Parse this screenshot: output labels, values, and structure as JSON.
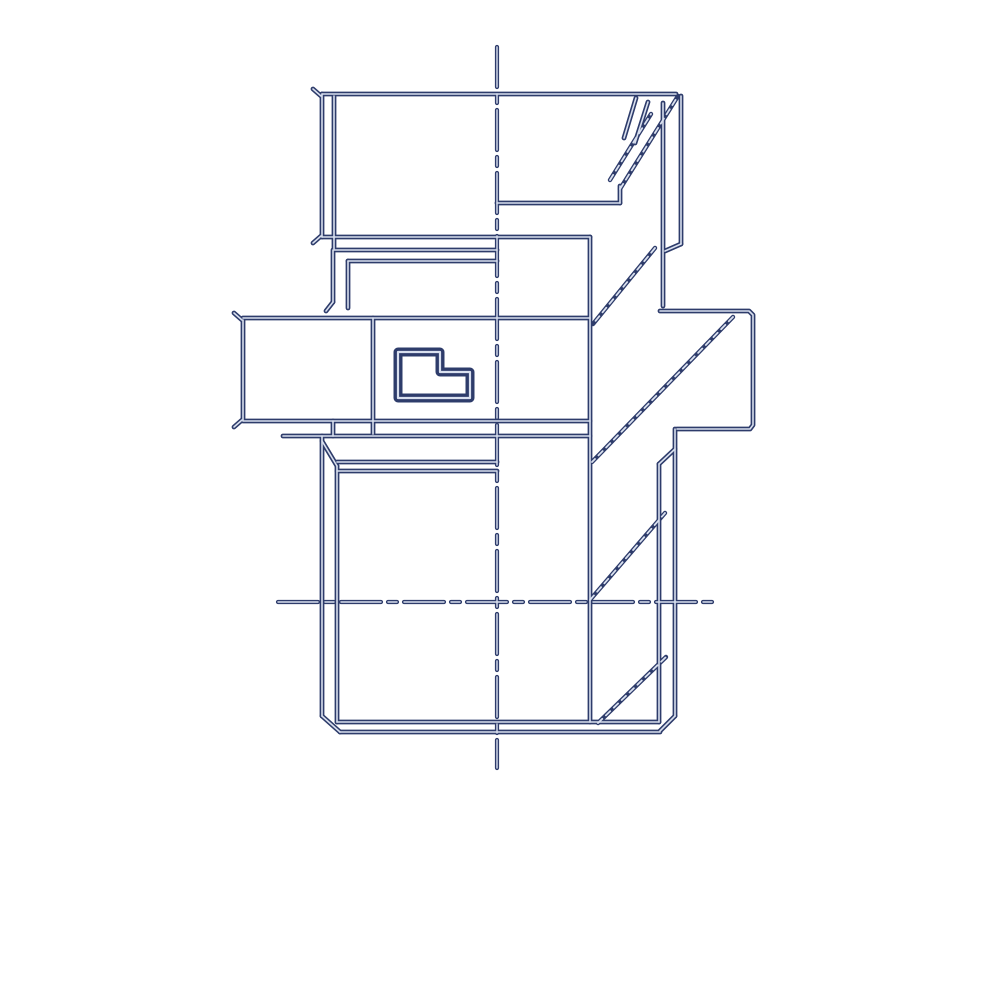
{
  "meta": {
    "description": "Technical line drawing of a hydraulic straight adapter fitting, side view with hex flats, male threaded stud and dash-dot centerlines"
  },
  "drawing": {
    "background": "#ffffff",
    "stroke_color": "#2e3c6b",
    "highlight_color": "#d9e0ef",
    "viewbox": "0 0 1000 1000",
    "layers": [
      {
        "name": "centerlines",
        "width": 4.2,
        "dash": "40 7 9 7",
        "highlight_width": 1.4,
        "highlight_dash": "40 7 9 7",
        "paths": [
          {
            "name": "vertical-centerline",
            "d": "M 497 47 L 497 768"
          },
          {
            "name": "horizontal-centerline",
            "d": "M 278 602 L 718 602"
          }
        ]
      },
      {
        "name": "outline",
        "width": 4.8,
        "highlight_width": 1.6,
        "paths": [
          {
            "name": "nut-top-edge",
            "d": "M 322 94 L 676 94"
          },
          {
            "name": "nut-left-edge",
            "d": "M 322 94 L 322 237"
          },
          {
            "name": "nut-left-facet",
            "d": "M 334 96 L 334 249"
          },
          {
            "name": "nut-right-edge",
            "d": "M 681 96 L 681 244"
          },
          {
            "name": "nut-right-facet",
            "d": "M 663 103 L 663 306"
          },
          {
            "name": "nut-bottom-edge",
            "d": "M 322 237 L 590 237"
          },
          {
            "name": "nut-washer-line",
            "d": "M 334 250 L 497 250"
          },
          {
            "name": "step-upper-line",
            "d": "M 497 203 L 620 203"
          },
          {
            "name": "step-stub",
            "d": "M 620 186 L 620 203"
          },
          {
            "name": "nut-corner-step",
            "d": "M 681 244 L 665 251"
          },
          {
            "name": "neck-left-outer",
            "d": "M 333 250 L 333 302"
          },
          {
            "name": "neck-flare",
            "d": "M 333 302 L 326 311"
          },
          {
            "name": "neck-left-inner",
            "d": "M 348 261 L 348 308"
          },
          {
            "name": "neck-shoulder",
            "d": "M 348 261 L 497 261"
          },
          {
            "name": "body-right-edge",
            "d": "M 590 237 L 590 722"
          },
          {
            "name": "flange-outline",
            "d": "M 660 311 L 749 311 L 753 315 L 753 425 L 750 429 L 677 429"
          },
          {
            "name": "hex-top-edge",
            "d": "M 243 318 L 590 318"
          },
          {
            "name": "hex-left-edge",
            "d": "M 243 320 L 243 420"
          },
          {
            "name": "hex-facet",
            "d": "M 373 318 L 373 434"
          },
          {
            "name": "hex-bottom-near",
            "d": "M 243 421 L 590 421"
          },
          {
            "name": "hex-bottom-far",
            "d": "M 283 436 L 590 436"
          },
          {
            "name": "hex-step",
            "d": "M 333 421 L 333 436"
          },
          {
            "name": "stud-left-major",
            "d": "M 322 436 L 322 716"
          },
          {
            "name": "stud-left-chamfer-top",
            "d": "M 322 441 L 337 466"
          },
          {
            "name": "stud-left-minor",
            "d": "M 337 466 L 337 722"
          },
          {
            "name": "thread-runout-a",
            "d": "M 337 462 L 497 462"
          },
          {
            "name": "thread-runout-b",
            "d": "M 337 471 L 497 471"
          },
          {
            "name": "stud-right-major",
            "d": "M 675 429 L 675 716"
          },
          {
            "name": "stud-right-chamfer-top",
            "d": "M 675 449 L 659 464"
          },
          {
            "name": "stud-right-minor",
            "d": "M 659 464 L 659 722"
          },
          {
            "name": "stud-bottom-chamfer-left",
            "d": "M 322 716 L 340 732"
          },
          {
            "name": "stud-bottom-face",
            "d": "M 340 732 L 660 732"
          },
          {
            "name": "stud-end-inner-line",
            "d": "M 337 722 L 659 722"
          },
          {
            "name": "stud-bottom-chamfer-right",
            "d": "M 675 716 L 660 731"
          },
          {
            "name": "tick-nut-top-left",
            "d": "M 321 96 L 313 89"
          },
          {
            "name": "tick-nut-bottom-left",
            "d": "M 321 236 L 313 243"
          },
          {
            "name": "tick-hex-top-left",
            "d": "M 242 320 L 234 313"
          },
          {
            "name": "tick-hex-bottom-left",
            "d": "M 242 420 L 234 427"
          },
          {
            "name": "nut-corner-hatch-a",
            "d": "M 636 98 L 624 138"
          },
          {
            "name": "nut-corner-hatch-b",
            "d": "M 648 102 L 635 143"
          }
        ]
      },
      {
        "name": "chamfer-diagonals",
        "width": 4.4,
        "highlight_width": 1.8,
        "highlight_dash": "6 5",
        "paths": [
          {
            "name": "chamfer-diagonal-neck",
            "d": "M 655 248 L 593 324"
          },
          {
            "name": "chamfer-diagonal-flange",
            "d": "M 733 317 L 592 462"
          },
          {
            "name": "chamfer-diagonal-mid",
            "d": "M 590 600 L 665 513"
          },
          {
            "name": "chamfer-diagonal-bottom",
            "d": "M 598 723 L 666 657"
          },
          {
            "name": "nut-chamfer-main",
            "d": "M 620 189 L 678 96"
          },
          {
            "name": "nut-chamfer-hatch",
            "d": "M 610 180 L 651 114"
          }
        ]
      },
      {
        "name": "logo",
        "width": 9,
        "highlight_width": 2.2,
        "paths": [
          {
            "name": "brand-glyph",
            "d": "M 398 352 L 440 352 L 440 372 L 470 372 L 470 398 L 398 398 Z"
          }
        ]
      }
    ]
  }
}
